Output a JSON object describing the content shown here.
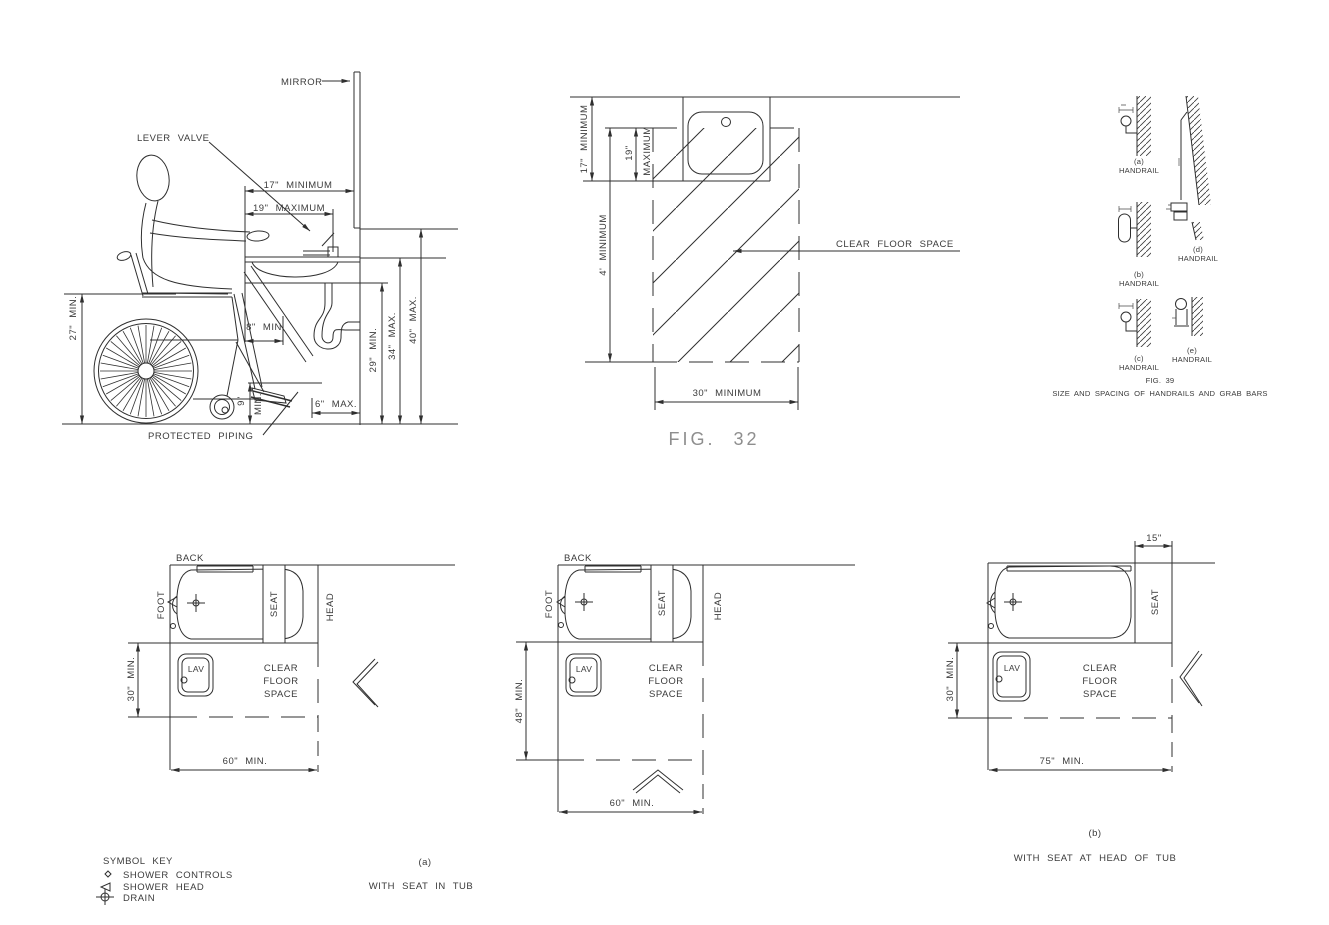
{
  "page": {
    "background": "#ffffff",
    "line_color": "#2f2f2f",
    "text_color": "#3b3b3b",
    "caption_color": "#8e8e8e"
  },
  "fig32": {
    "caption": "FIG. 32",
    "elevation": {
      "mirror_label": "MIRROR",
      "lever_valve_label": "LEVER VALVE",
      "protected_piping_label": "PROTECTED PIPING",
      "dim_17": "17\" MINIMUM",
      "dim_19": "19\" MAXIMUM",
      "dim_27": "27\" MIN.",
      "dim_8": "8\" MIN",
      "dim_9_a": "9\"",
      "dim_9_b": "MIN.",
      "dim_29": "29\" MIN.",
      "dim_34": "34\" MAX.",
      "dim_40": "40\" MAX.",
      "dim_6": "6\" MAX."
    },
    "plan": {
      "dim_17": "17\" MINIMUM",
      "dim_19_a": "19\"",
      "dim_19_b": "MAXIMUM",
      "dim_4ft": "4' MINIMUM",
      "dim_30": "30\" MINIMUM",
      "clear_floor_space_label": "CLEAR FLOOR SPACE"
    }
  },
  "fig39": {
    "caption_line1": "FIG. 39",
    "caption_line2": "SIZE AND SPACING OF HANDRAILS AND GRAB BARS",
    "details": [
      {
        "tag": "(a)",
        "label": "HANDRAIL"
      },
      {
        "tag": "(b)",
        "label": "HANDRAIL"
      },
      {
        "tag": "(c)",
        "label": "HANDRAIL"
      },
      {
        "tag": "(d)",
        "label": "HANDRAIL"
      },
      {
        "tag": "(e)",
        "label": "HANDRAIL"
      }
    ]
  },
  "tubs": {
    "back_label": "BACK",
    "foot_label": "FOOT",
    "head_label": "HEAD",
    "seat_label": "SEAT",
    "lav_label": "LAV",
    "cfs_line1": "CLEAR",
    "cfs_line2": "FLOOR",
    "cfs_line3": "SPACE",
    "a1": {
      "dim_v": "30\" MIN.",
      "dim_h": "60\" MIN."
    },
    "a2": {
      "dim_v": "48\" MIN.",
      "dim_h": "60\" MIN."
    },
    "b": {
      "dim_v": "30\" MIN.",
      "dim_h": "75\" MIN.",
      "dim_offset": "15\""
    },
    "caption_a_tag": "(a)",
    "caption_a_text": "WITH SEAT IN TUB",
    "caption_b_tag": "(b)",
    "caption_b_text": "WITH SEAT AT HEAD OF TUB"
  },
  "symbol_key": {
    "title": "SYMBOL KEY",
    "items": [
      {
        "icon": "shower-controls-symbol",
        "label": "SHOWER CONTROLS"
      },
      {
        "icon": "shower-head-symbol",
        "label": "SHOWER HEAD"
      },
      {
        "icon": "drain-symbol",
        "label": "DRAIN"
      }
    ]
  }
}
